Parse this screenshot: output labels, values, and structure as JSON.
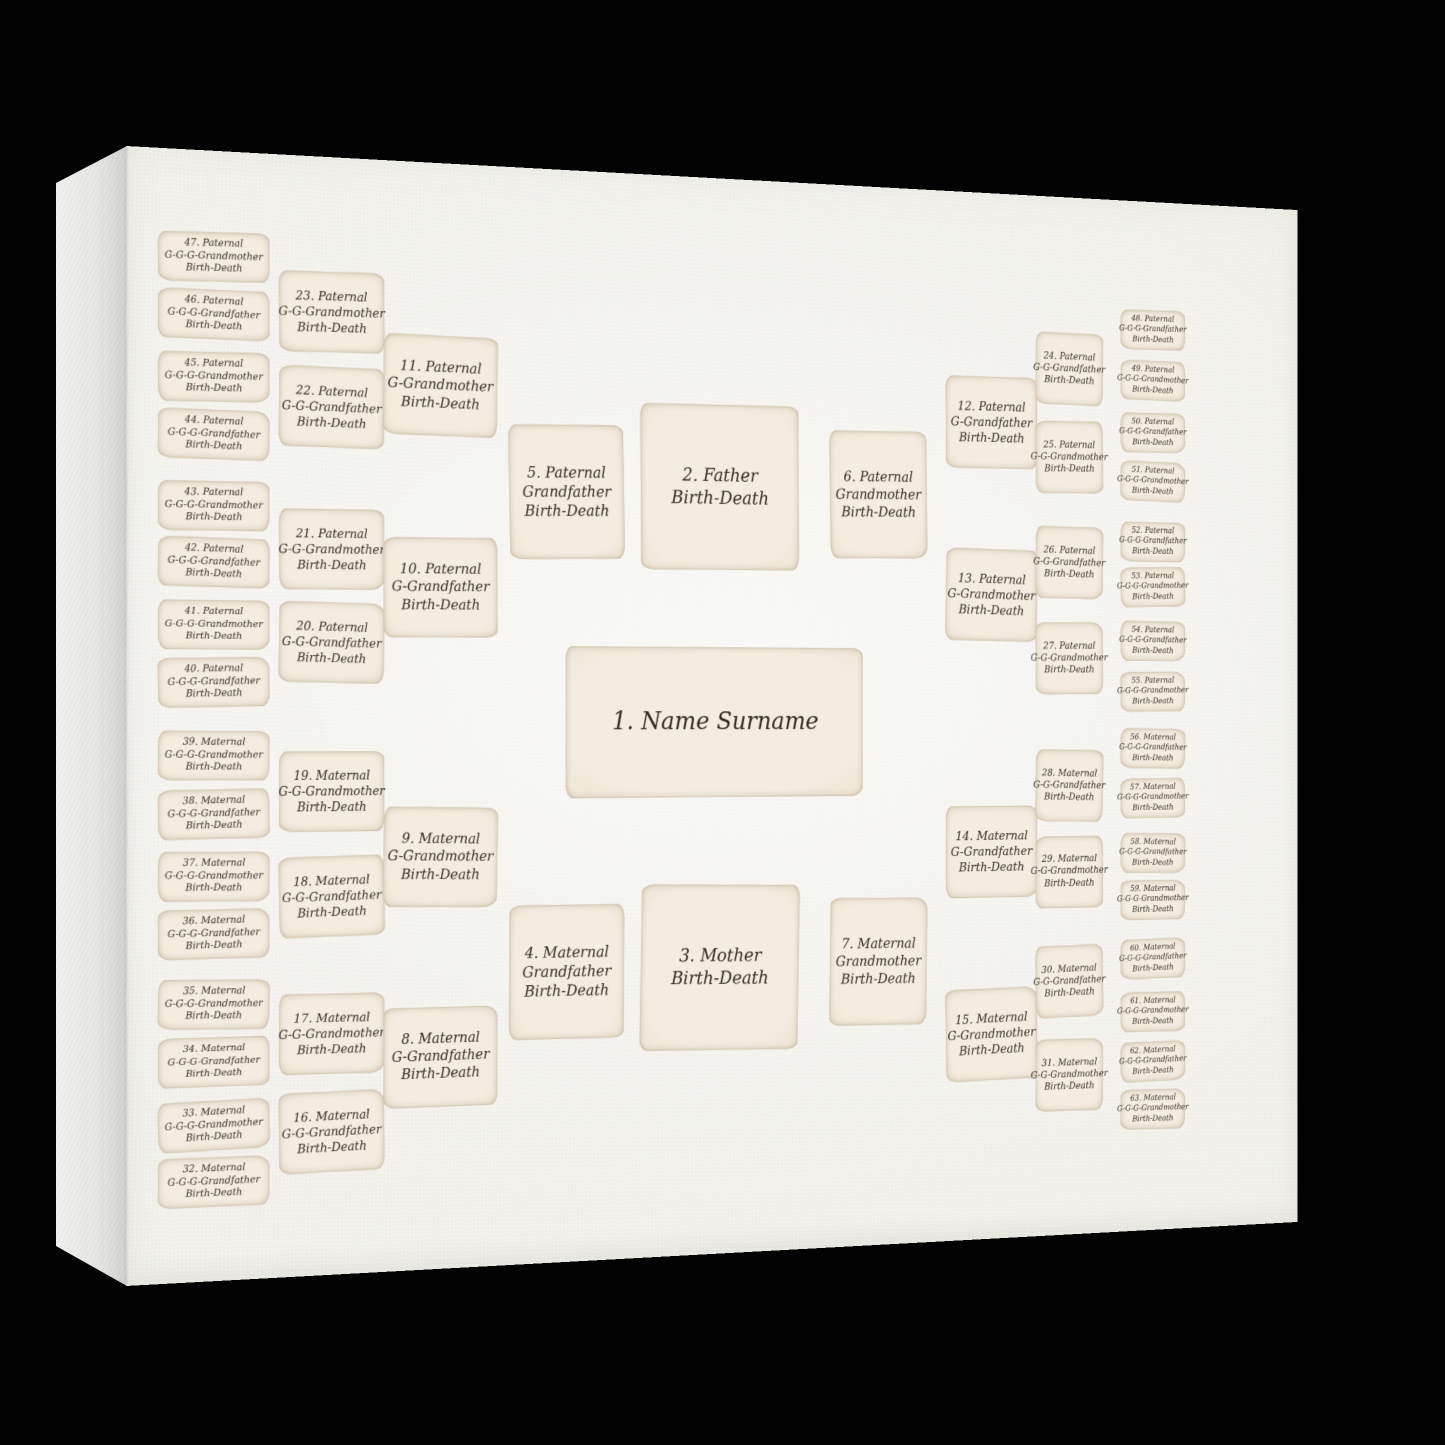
{
  "product": {
    "type_label": "family tree canvas print",
    "colors": {
      "background": "#030303",
      "canvas_front": "#f4f3ee",
      "canvas_side": "#e7e7e4",
      "card_fill": "#f0e9da",
      "card_edge": "#c3b499",
      "ink": "#342a1e"
    }
  },
  "chart": {
    "proband_card": {
      "lines": [
        "1. Name Surname"
      ]
    },
    "father_card": {
      "lines": [
        "2. Father",
        "Birth-Death"
      ]
    },
    "mother_card": {
      "lines": [
        "3. Mother",
        "Birth-Death"
      ]
    },
    "columns": [
      {
        "id": "ggg-grandparents-left",
        "cards": [
          {
            "lines": [
              "47. Paternal",
              "G-G-G-Grandmother",
              "Birth-Death"
            ]
          },
          {
            "lines": [
              "46. Paternal",
              "G-G-G-Grandfather",
              "Birth-Death"
            ]
          },
          {
            "lines": [
              "45. Paternal",
              "G-G-G-Grandmother",
              "Birth-Death"
            ]
          },
          {
            "lines": [
              "44. Paternal",
              "G-G-G-Grandfather",
              "Birth-Death"
            ]
          },
          {
            "lines": [
              "43. Paternal",
              "G-G-G-Grandmother",
              "Birth-Death"
            ]
          },
          {
            "lines": [
              "42. Paternal",
              "G-G-G-Grandfather",
              "Birth-Death"
            ]
          },
          {
            "lines": [
              "41. Paternal",
              "G-G-G-Grandmother",
              "Birth-Death"
            ]
          },
          {
            "lines": [
              "40. Paternal",
              "G-G-G-Grandfather",
              "Birth-Death"
            ]
          },
          {
            "lines": [
              "39. Maternal",
              "G-G-G-Grandmother",
              "Birth-Death"
            ]
          },
          {
            "lines": [
              "38. Maternal",
              "G-G-G-Grandfather",
              "Birth-Death"
            ]
          },
          {
            "lines": [
              "37. Maternal",
              "G-G-G-Grandmother",
              "Birth-Death"
            ]
          },
          {
            "lines": [
              "36. Maternal",
              "G-G-G-Grandfather",
              "Birth-Death"
            ]
          },
          {
            "lines": [
              "35. Maternal",
              "G-G-G-Grandmother",
              "Birth-Death"
            ]
          },
          {
            "lines": [
              "34. Maternal",
              "G-G-G-Grandfather",
              "Birth-Death"
            ]
          },
          {
            "lines": [
              "33. Maternal",
              "G-G-G-Grandmother",
              "Birth-Death"
            ]
          },
          {
            "lines": [
              "32. Maternal",
              "G-G-G-Grandfather",
              "Birth-Death"
            ]
          }
        ]
      },
      {
        "id": "gg-grandparents-left",
        "cards": [
          {
            "lines": [
              "23. Paternal",
              "G-G-Grandmother",
              "Birth-Death"
            ]
          },
          {
            "lines": [
              "22. Paternal",
              "G-G-Grandfather",
              "Birth-Death"
            ]
          },
          {
            "lines": [
              "21. Paternal",
              "G-G-Grandmother",
              "Birth-Death"
            ]
          },
          {
            "lines": [
              "20. Paternal",
              "G-G-Grandfather",
              "Birth-Death"
            ]
          },
          {
            "lines": [
              "19. Maternal",
              "G-G-Grandmother",
              "Birth-Death"
            ]
          },
          {
            "lines": [
              "18. Maternal",
              "G-G-Grandfather",
              "Birth-Death"
            ]
          },
          {
            "lines": [
              "17. Maternal",
              "G-G-Grandmother",
              "Birth-Death"
            ]
          },
          {
            "lines": [
              "16. Maternal",
              "G-G-Grandfather",
              "Birth-Death"
            ]
          }
        ]
      },
      {
        "id": "g-grandparents-left",
        "cards": [
          {
            "lines": [
              "11. Paternal",
              "G-Grandmother",
              "Birth-Death"
            ]
          },
          {
            "lines": [
              "10. Paternal",
              "G-Grandfather",
              "Birth-Death"
            ]
          },
          {
            "lines": [
              "9. Maternal",
              "G-Grandmother",
              "Birth-Death"
            ]
          },
          {
            "lines": [
              "8. Maternal",
              "G-Grandfather",
              "Birth-Death"
            ]
          }
        ]
      },
      {
        "id": "grandfathers",
        "cards": [
          {
            "lines": [
              "5. Paternal",
              "Grandfather",
              "Birth-Death"
            ]
          },
          {
            "lines": [
              "4. Maternal",
              "Grandfather",
              "Birth-Death"
            ]
          }
        ]
      },
      {
        "id": "grandmothers",
        "cards": [
          {
            "lines": [
              "6. Paternal",
              "Grandmother",
              "Birth-Death"
            ]
          },
          {
            "lines": [
              "7. Maternal",
              "Grandmother",
              "Birth-Death"
            ]
          }
        ]
      },
      {
        "id": "g-grandparents-right",
        "cards": [
          {
            "lines": [
              "12. Paternal",
              "G-Grandfather",
              "Birth-Death"
            ]
          },
          {
            "lines": [
              "13. Paternal",
              "G-Grandmother",
              "Birth-Death"
            ]
          },
          {
            "lines": [
              "14. Maternal",
              "G-Grandfather",
              "Birth-Death"
            ]
          },
          {
            "lines": [
              "15. Maternal",
              "G-Grandmother",
              "Birth-Death"
            ]
          }
        ]
      },
      {
        "id": "gg-grandparents-right",
        "cards": [
          {
            "lines": [
              "24. Paternal",
              "G-G-Grandfather",
              "Birth-Death"
            ]
          },
          {
            "lines": [
              "25. Paternal",
              "G-G-Grandmother",
              "Birth-Death"
            ]
          },
          {
            "lines": [
              "26. Paternal",
              "G-G-Grandfather",
              "Birth-Death"
            ]
          },
          {
            "lines": [
              "27. Paternal",
              "G-G-Grandmother",
              "Birth-Death"
            ]
          },
          {
            "lines": [
              "28. Maternal",
              "G-G-Grandfather",
              "Birth-Death"
            ]
          },
          {
            "lines": [
              "29. Maternal",
              "G-G-Grandmother",
              "Birth-Death"
            ]
          },
          {
            "lines": [
              "30. Maternal",
              "G-G-Grandfather",
              "Birth-Death"
            ]
          },
          {
            "lines": [
              "31. Maternal",
              "G-G-Grandmother",
              "Birth-Death"
            ]
          }
        ]
      },
      {
        "id": "ggg-grandparents-right",
        "cards": [
          {
            "lines": [
              "48. Paternal",
              "G-G-G-Grandfather",
              "Birth-Death"
            ]
          },
          {
            "lines": [
              "49. Paternal",
              "G-G-G-Grandmother",
              "Birth-Death"
            ]
          },
          {
            "lines": [
              "50. Paternal",
              "G-G-G-Grandfather",
              "Birth-Death"
            ]
          },
          {
            "lines": [
              "51. Paternal",
              "G-G-G-Grandmother",
              "Birth-Death"
            ]
          },
          {
            "lines": [
              "52. Paternal",
              "G-G-G-Grandfather",
              "Birth-Death"
            ]
          },
          {
            "lines": [
              "53. Paternal",
              "G-G-G-Grandmother",
              "Birth-Death"
            ]
          },
          {
            "lines": [
              "54. Paternal",
              "G-G-G-Grandfather",
              "Birth-Death"
            ]
          },
          {
            "lines": [
              "55. Paternal",
              "G-G-G-Grandmother",
              "Birth-Death"
            ]
          },
          {
            "lines": [
              "56. Maternal",
              "G-G-G-Grandfather",
              "Birth-Death"
            ]
          },
          {
            "lines": [
              "57. Maternal",
              "G-G-G-Grandmother",
              "Birth-Death"
            ]
          },
          {
            "lines": [
              "58. Maternal",
              "G-G-G-Grandfather",
              "Birth-Death"
            ]
          },
          {
            "lines": [
              "59. Maternal",
              "G-G-G-Grandmother",
              "Birth-Death"
            ]
          },
          {
            "lines": [
              "60. Maternal",
              "G-G-G-Grandfather",
              "Birth-Death"
            ]
          },
          {
            "lines": [
              "61. Maternal",
              "G-G-G-Grandmother",
              "Birth-Death"
            ]
          },
          {
            "lines": [
              "62. Maternal",
              "G-G-G-Grandfather",
              "Birth-Death"
            ]
          },
          {
            "lines": [
              "63. Maternal",
              "G-G-G-Grandmother",
              "Birth-Death"
            ]
          }
        ]
      }
    ]
  }
}
